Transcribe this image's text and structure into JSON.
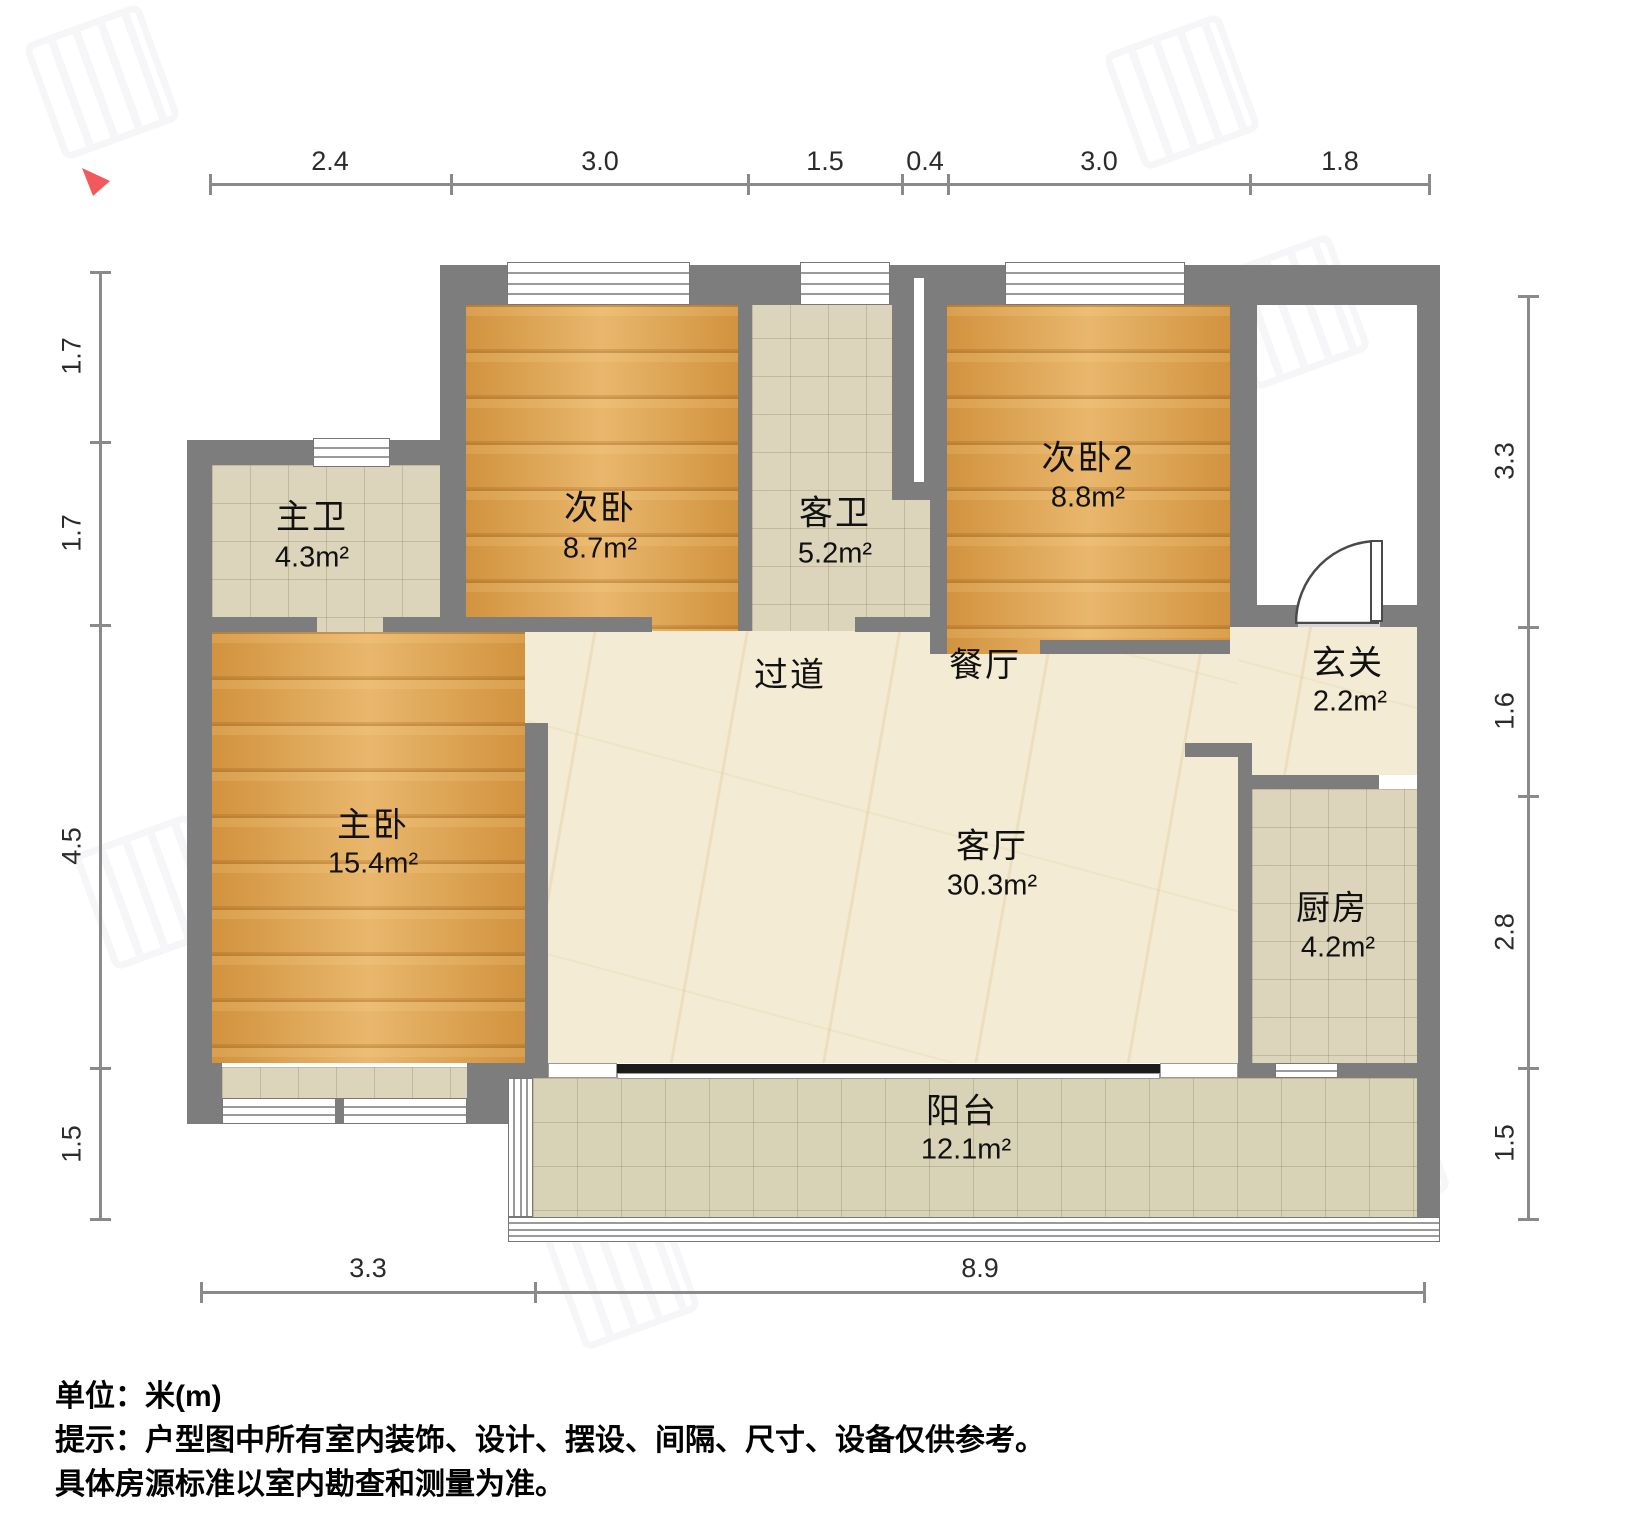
{
  "dimensions": {
    "top": [
      "2.4",
      "3.0",
      "1.5",
      "0.4",
      "3.0",
      "1.8"
    ],
    "left": [
      "1.7",
      "1.7",
      "4.5",
      "1.5"
    ],
    "right": [
      "3.3",
      "1.6",
      "2.8",
      "1.5"
    ],
    "bottom": [
      "3.3",
      "8.9"
    ]
  },
  "rooms": {
    "cw1": {
      "name": "次卧",
      "area": "8.7m²"
    },
    "kw": {
      "name": "客卫",
      "area": "5.2m²"
    },
    "cw2": {
      "name": "次卧2",
      "area": "8.8m²"
    },
    "zw": {
      "name": "主卫",
      "area": "4.3m²"
    },
    "zwo": {
      "name": "主卧",
      "area": "15.4m²"
    },
    "gd": {
      "name": "过道"
    },
    "ct": {
      "name": "餐厅"
    },
    "xg": {
      "name": "玄关",
      "area": "2.2m²"
    },
    "kt": {
      "name": "客厅",
      "area": "30.3m²"
    },
    "cf": {
      "name": "厨房",
      "area": "4.2m²"
    },
    "yt": {
      "name": "阳台",
      "area": "12.1m²"
    }
  },
  "footer": {
    "unit_line": "单位：米(m)",
    "tip_line1": "提示：户型图中所有室内装饰、设计、摆设、间隔、尺寸、设备仅供参考。",
    "tip_line2": "具体房源标准以室内勘查和测量为准。"
  },
  "colors": {
    "wall": "#7d7d7d",
    "wood_floor": "#e0a149",
    "tile_floor": "#dcd5bc",
    "marble_floor": "#f4ebd4",
    "balcony_floor": "#d8d2b6",
    "north_marker": "#f2595b"
  }
}
